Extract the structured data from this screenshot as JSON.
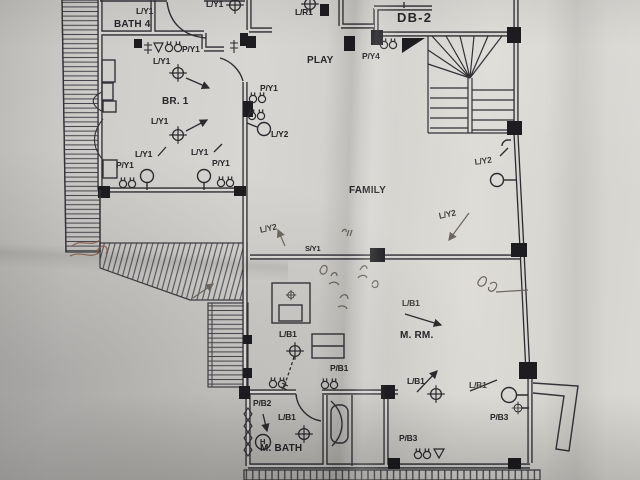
{
  "labels": [
    {
      "text": "L/Y1"
    },
    {
      "text": "L/Y1"
    },
    {
      "text": "L/R1"
    },
    {
      "text": "DB-2"
    },
    {
      "text": "BATH 4"
    },
    {
      "text": "P/Y1"
    },
    {
      "text": "P/Y4"
    },
    {
      "text": "PLAY"
    },
    {
      "text": "L/Y1"
    },
    {
      "text": "P/Y1"
    },
    {
      "text": "BR. 1"
    },
    {
      "text": "L/Y1"
    },
    {
      "text": "L/Y2"
    },
    {
      "text": "L/Y2"
    },
    {
      "text": "L/Y1"
    },
    {
      "text": "L/Y1"
    },
    {
      "text": "P/Y1"
    },
    {
      "text": "P/Y1"
    },
    {
      "text": "FAMILY"
    },
    {
      "text": "L/Y2"
    },
    {
      "text": "L/Y2"
    },
    {
      "text": "S/Y1"
    },
    {
      "text": "L/B1"
    },
    {
      "text": "M. RM."
    },
    {
      "text": "L/B1"
    },
    {
      "text": "P/B1"
    },
    {
      "text": "P/B2"
    },
    {
      "text": "L/B1"
    },
    {
      "text": "L/B1"
    },
    {
      "text": "L/B1"
    },
    {
      "text": "P/B3"
    },
    {
      "text": "P/B3"
    },
    {
      "text": "M. BATH"
    },
    {
      "text": "H"
    }
  ],
  "colors": {
    "ink": "#2b2b30",
    "pencil": "#6b665f",
    "red_pencil": "#8a5a48",
    "paper": "#d7d5d1"
  }
}
